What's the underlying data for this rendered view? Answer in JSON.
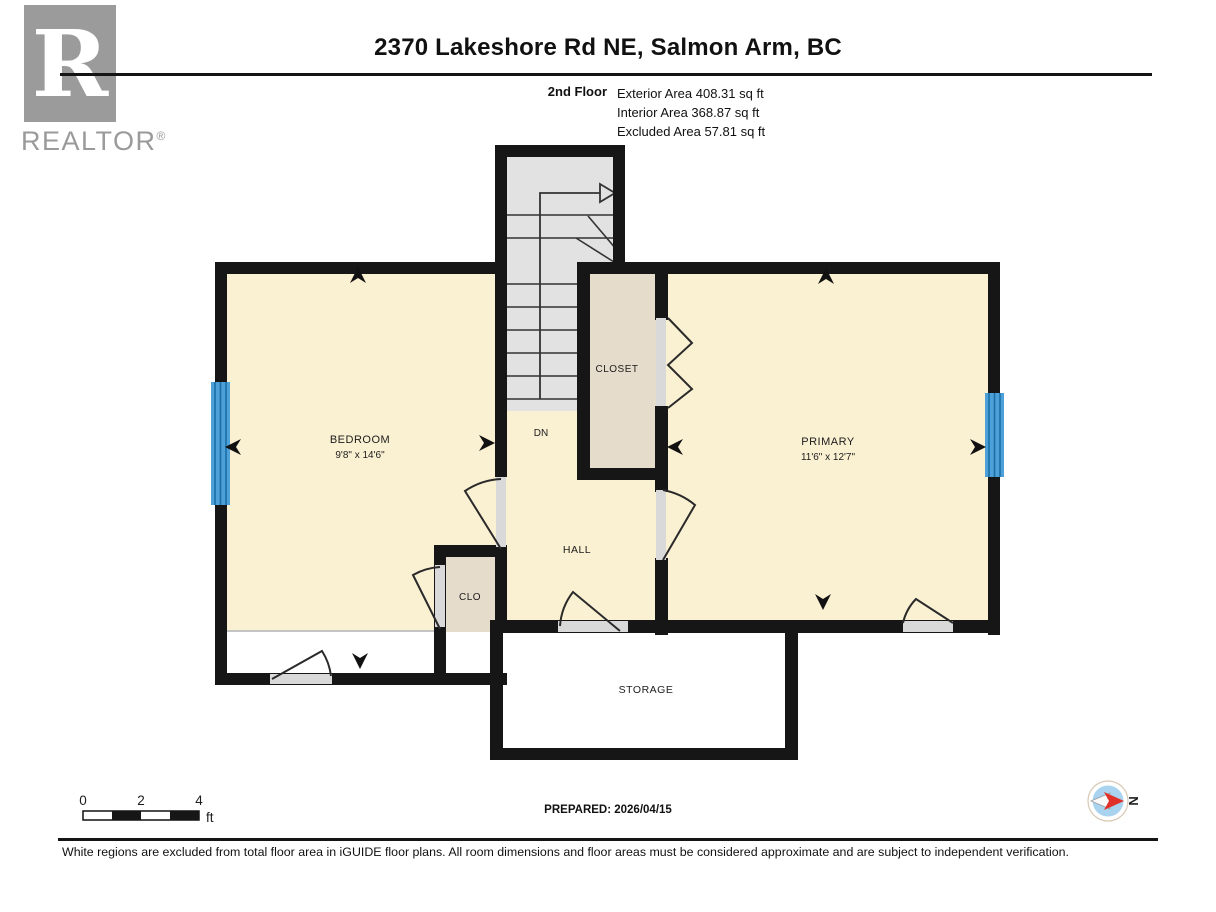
{
  "header": {
    "title": "2370 Lakeshore Rd NE, Salmon Arm, BC",
    "floor_label": "2nd Floor",
    "area_lines": {
      "exterior": "Exterior Area 408.31 sq ft",
      "interior": "Interior Area 368.87 sq ft",
      "excluded": "Excluded Area 57.81 sq ft"
    }
  },
  "logo": {
    "letter": "R",
    "wordmark": "REALTOR",
    "registered": "®"
  },
  "plan": {
    "rooms": {
      "bedroom": {
        "name": "BEDROOM",
        "dimensions": "9'8\" x 14'6\""
      },
      "primary": {
        "name": "PRIMARY",
        "dimensions": "11'6\" x 12'7\""
      },
      "closet": {
        "name": "CLOSET"
      },
      "hall": {
        "name": "HALL"
      },
      "clo": {
        "name": "CLO"
      },
      "storage": {
        "name": "STORAGE"
      },
      "stairs": {
        "label": "DN"
      }
    },
    "colors": {
      "room_fill": "#FAF0D2",
      "closet_fill": "#E5DCCB",
      "stairs_fill": "#E2E2E2",
      "excluded_fill": "#FFFFFF",
      "wall": "#161616",
      "window": "#4DA0D8",
      "window_stripe": "#1A6FA6",
      "threshold": "#D9D9D9",
      "compass_red": "#E03028"
    }
  },
  "scale_bar": {
    "labels": {
      "zero": "0",
      "two": "2",
      "four": "4"
    },
    "unit": "ft"
  },
  "footer": {
    "prepared": "PREPARED: 2026/04/15",
    "compass": "N",
    "disclaimer": "White regions are excluded from total floor area in iGUIDE floor plans. All room dimensions and floor areas must be considered approximate and are subject to independent verification."
  }
}
